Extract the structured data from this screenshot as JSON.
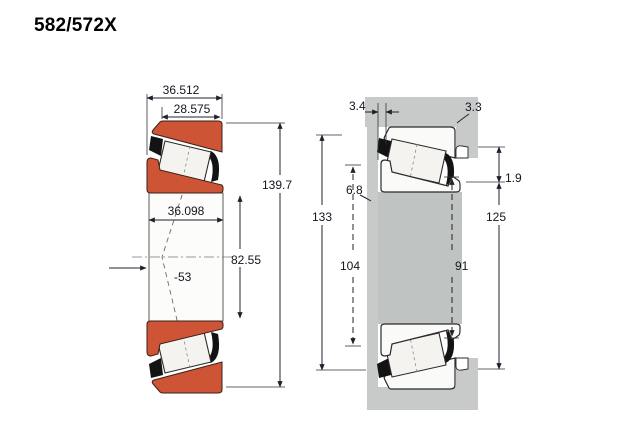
{
  "title": "582/572X",
  "left_view": {
    "name": "bearing cross-section",
    "dim_total_width": "36.512",
    "dim_cup_width": "28.575",
    "dim_outer_diameter": "139.7",
    "dim_cone_width": "36.098",
    "dim_bore": "82.55",
    "dim_angle": "-53"
  },
  "right_view": {
    "name": "mounted bearing arrangement",
    "dim_backing_clearance": "3.4",
    "dim_housing_fillet": "3.3",
    "dim_cone_backface": "6.8",
    "dim_cup_standout": "1.9",
    "dim_shoulder_133": "133",
    "dim_shoulder_125": "125",
    "dim_shoulder_104": "104",
    "dim_shoulder_91": "91"
  },
  "colors": {
    "ring_orange": "#cd5434",
    "housing_gray": "#c7cac9",
    "shaft_gray": "#bfc3c2",
    "line": "#20202c"
  }
}
